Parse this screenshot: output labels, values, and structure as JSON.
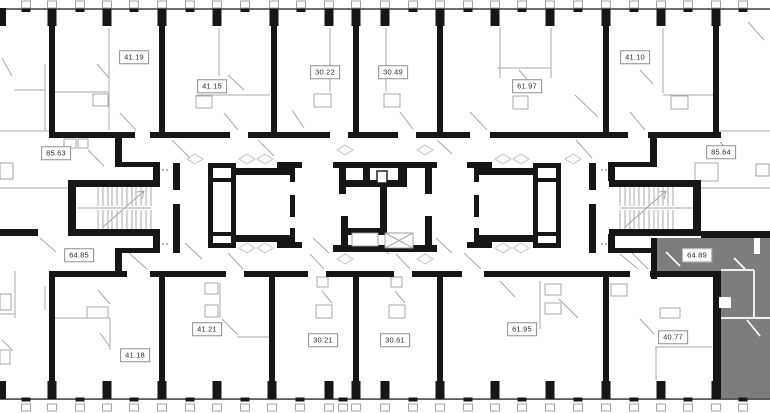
{
  "plan": {
    "selected_area": "64.89",
    "colors": {
      "walls": "#161616",
      "details": "#a8a8a8",
      "highlight": "#7d7d7d",
      "background": "#ffffff"
    },
    "units": [
      {
        "id": "unit-41-19",
        "area": "41.19",
        "selected": false
      },
      {
        "id": "unit-41-15",
        "area": "41.15",
        "selected": false
      },
      {
        "id": "unit-30-22",
        "area": "30.22",
        "selected": false
      },
      {
        "id": "unit-30-49",
        "area": "30.49",
        "selected": false
      },
      {
        "id": "unit-61-97",
        "area": "61.97",
        "selected": false
      },
      {
        "id": "unit-41-10",
        "area": "41.10",
        "selected": false
      },
      {
        "id": "unit-85-63",
        "area": "85.63",
        "selected": false
      },
      {
        "id": "unit-85-64",
        "area": "85.64",
        "selected": false
      },
      {
        "id": "unit-64-85",
        "area": "64.85",
        "selected": false
      },
      {
        "id": "unit-64-89",
        "area": "64.89",
        "selected": true
      },
      {
        "id": "unit-41-18",
        "area": "41.18",
        "selected": false
      },
      {
        "id": "unit-41-21",
        "area": "41.21",
        "selected": false
      },
      {
        "id": "unit-30-21",
        "area": "30.21",
        "selected": false
      },
      {
        "id": "unit-30-61",
        "area": "30.61",
        "selected": false
      },
      {
        "id": "unit-61-95",
        "area": "61.95",
        "selected": false
      },
      {
        "id": "unit-40-77",
        "area": "40.77",
        "selected": false
      }
    ]
  }
}
